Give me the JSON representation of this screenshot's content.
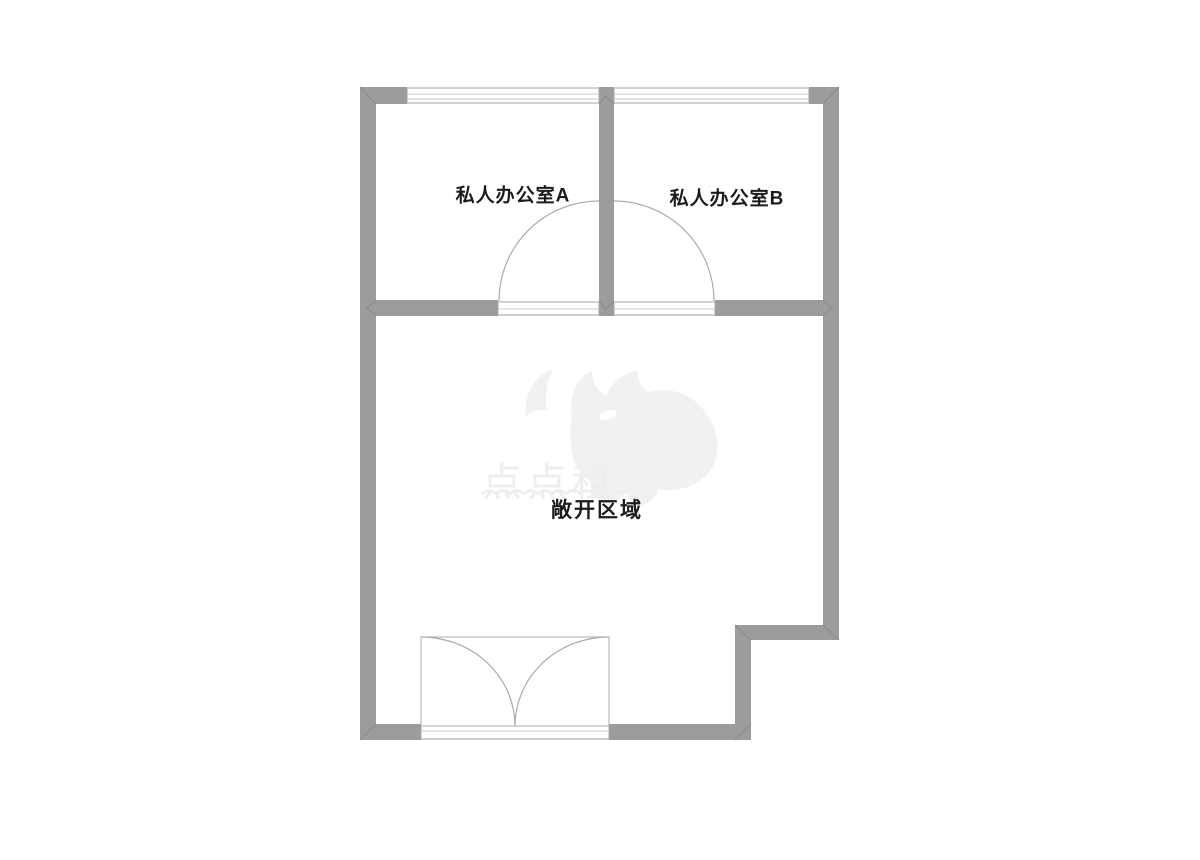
{
  "floorplan": {
    "rooms": [
      {
        "id": "private-office-a",
        "label": "私人办公室A"
      },
      {
        "id": "private-office-b",
        "label": "私人办公室B"
      },
      {
        "id": "open-area",
        "label": "敞开区域"
      }
    ],
    "watermark": {
      "text": "点点租",
      "logo": "rhino-logo"
    },
    "colors": {
      "wall": "#9c9c9c",
      "wall_seam": "#8a8a8a",
      "fixture_line": "#a6a6a6",
      "fixture_inner_line": "#c9c9c9",
      "door_arc": "#ababab",
      "label_text": "#1c1c1c",
      "watermark": "#f0eded",
      "watermark_logo": "#f1f1f1"
    }
  }
}
